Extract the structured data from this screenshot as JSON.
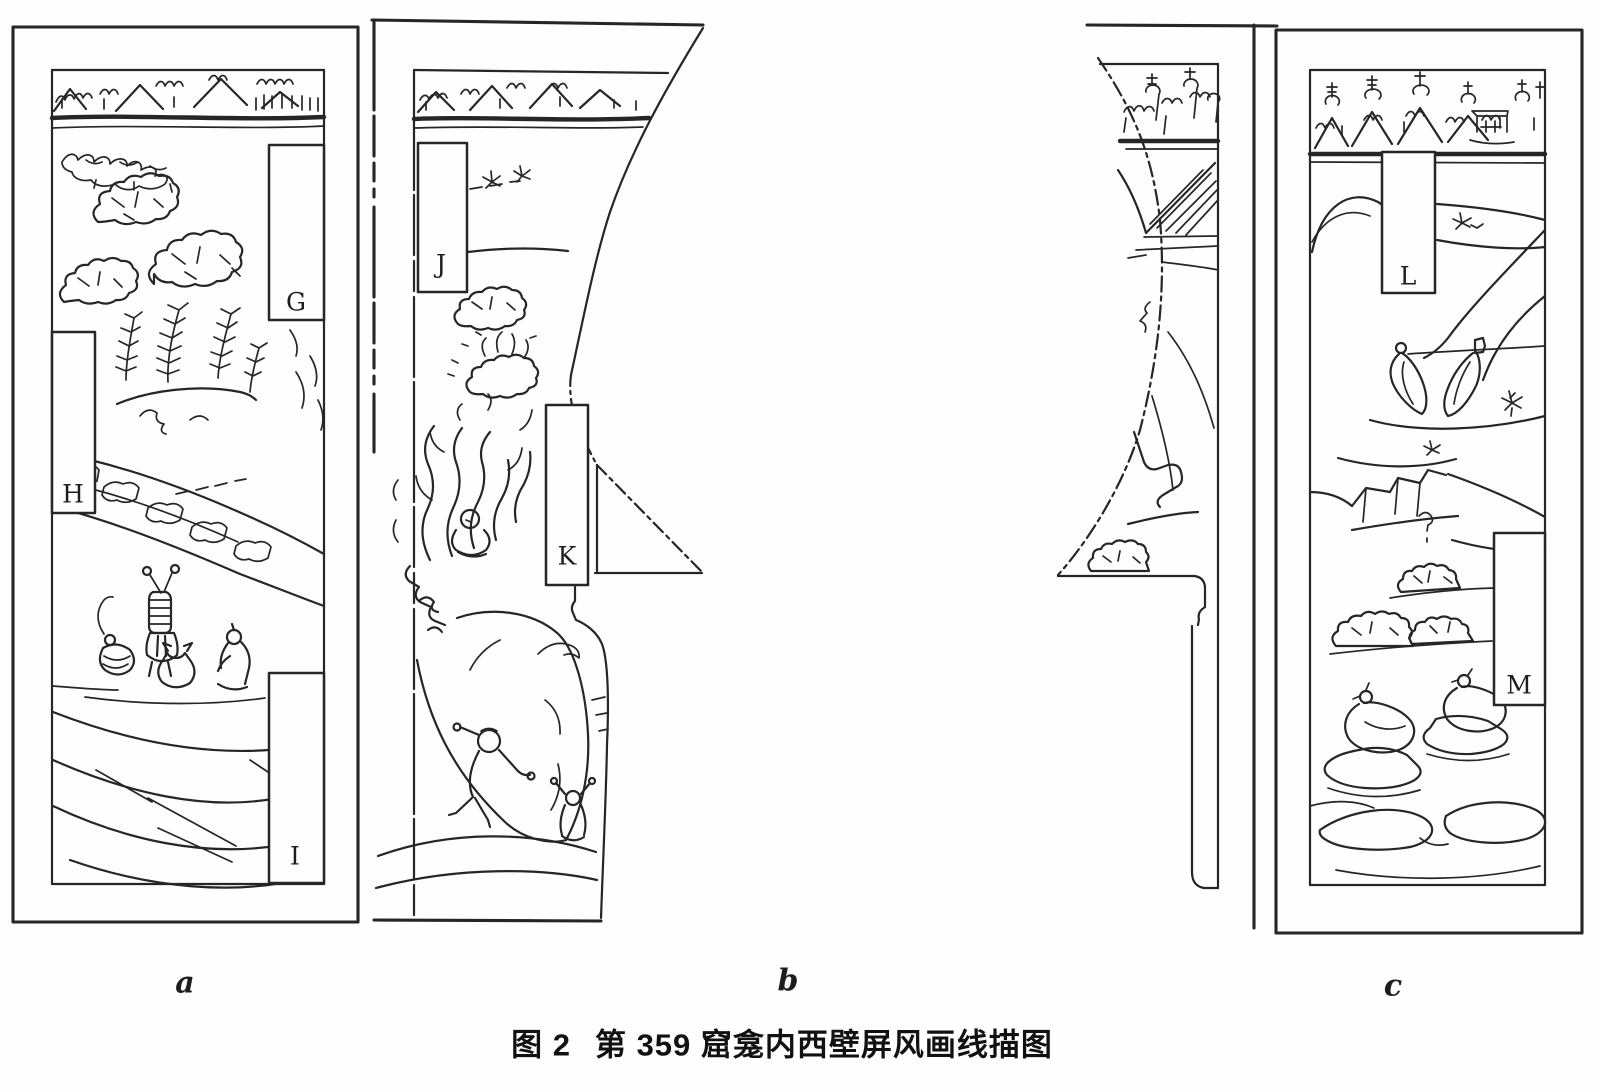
{
  "figure": {
    "caption_prefix": "图 2",
    "caption_title": "第 359 窟龛内西壁屏风画线描图"
  },
  "panels": [
    {
      "label": "a",
      "cartouches": [
        {
          "letter": "G"
        },
        {
          "letter": "H"
        },
        {
          "letter": "I"
        }
      ]
    },
    {
      "label": "b",
      "cartouches": [
        {
          "letter": "J"
        },
        {
          "letter": "K"
        }
      ]
    },
    {
      "label": "c",
      "cartouches": [
        {
          "letter": "L"
        },
        {
          "letter": "M"
        }
      ]
    }
  ],
  "colors": {
    "ink": "#262626",
    "paper": "#fefefe"
  }
}
